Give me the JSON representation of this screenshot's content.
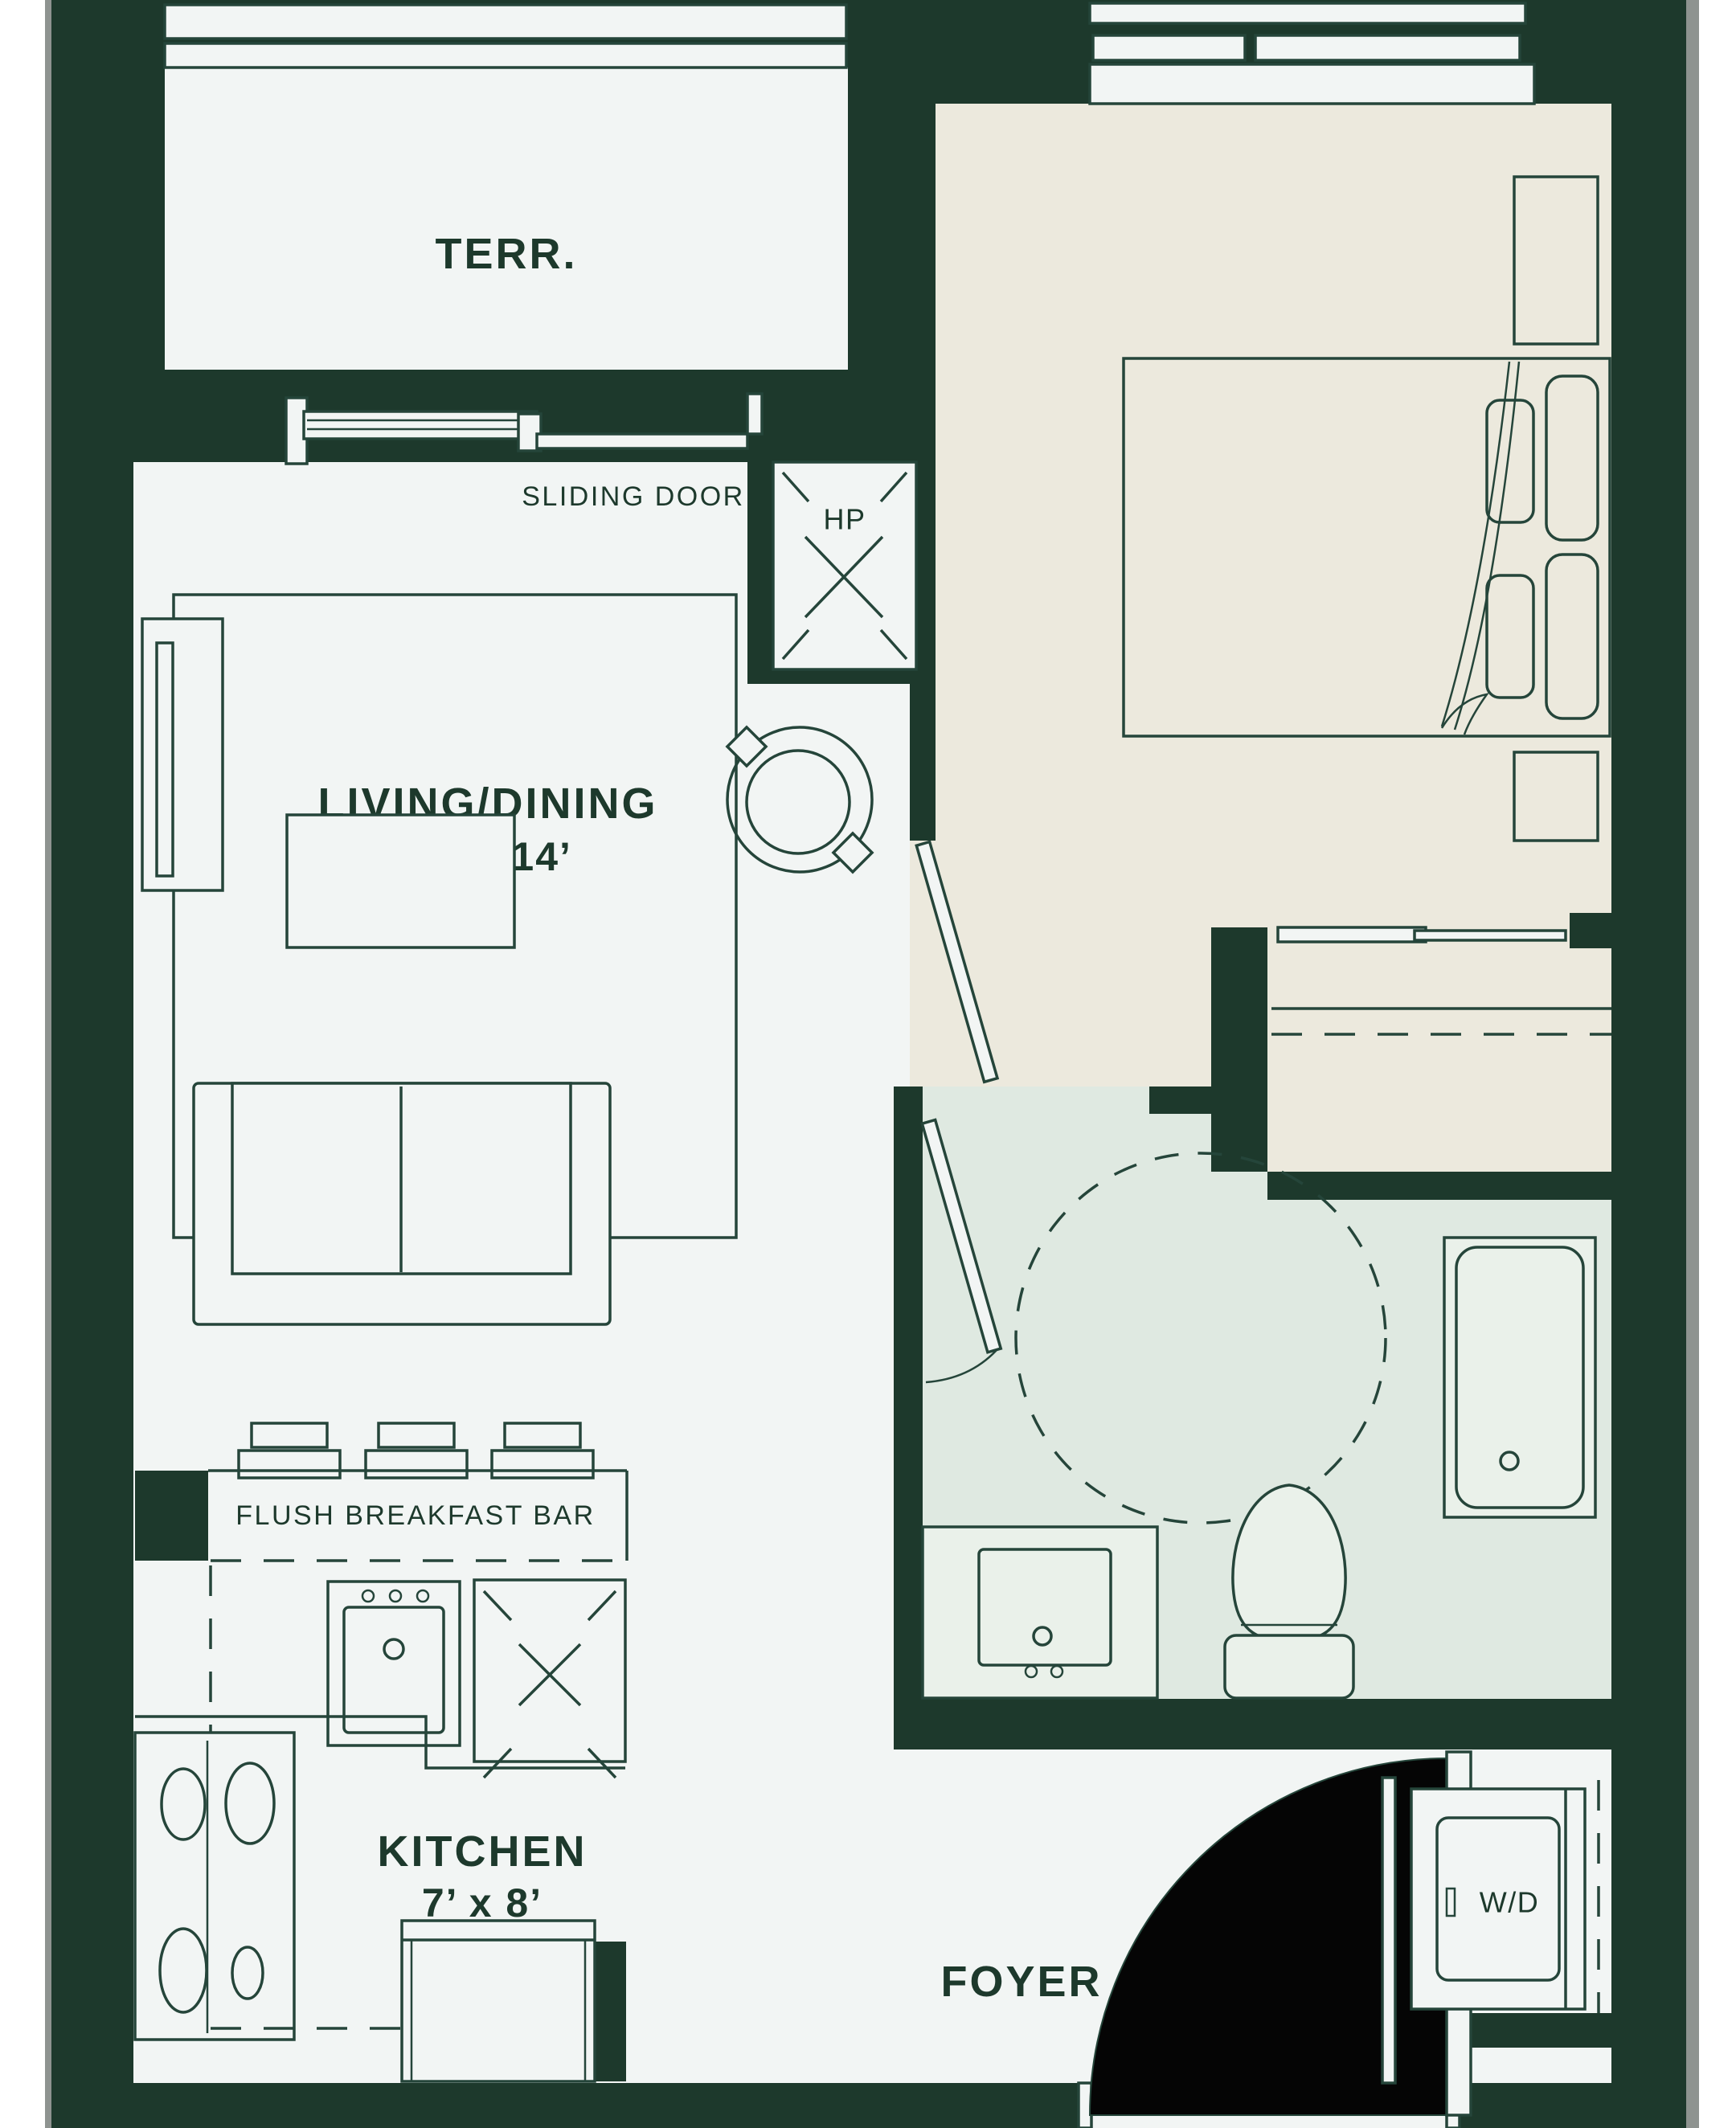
{
  "colors": {
    "page_bg": "#ffffff",
    "edge_gray": "#8e9390",
    "wall_green": "#1d392c",
    "line_green": "#25453a",
    "floor_white": "#f2f5f4",
    "bedroom_cream": "#ece9dd",
    "bath_mint": "#dfe9e1",
    "tub_fill": "#eaf1ea",
    "door_black": "#050505",
    "text_green": "#1d392c"
  },
  "rooms": {
    "terrace": {
      "label": "TERR."
    },
    "living": {
      "label": "LIVING/DINING",
      "dimensions": "10’ x 14’"
    },
    "bedroom": {
      "label": "BEDROOM",
      "dimensions": "9’ x 11’"
    },
    "kitchen": {
      "label": "KITCHEN",
      "dimensions": "7’ x 8’"
    },
    "foyer": {
      "label": "FOYER"
    }
  },
  "annotations": {
    "sliding_door": "SLIDING DOOR",
    "breakfast_bar": "FLUSH BREAKFAST BAR",
    "heat_pump": "HP",
    "washer_dryer": "W/D"
  }
}
